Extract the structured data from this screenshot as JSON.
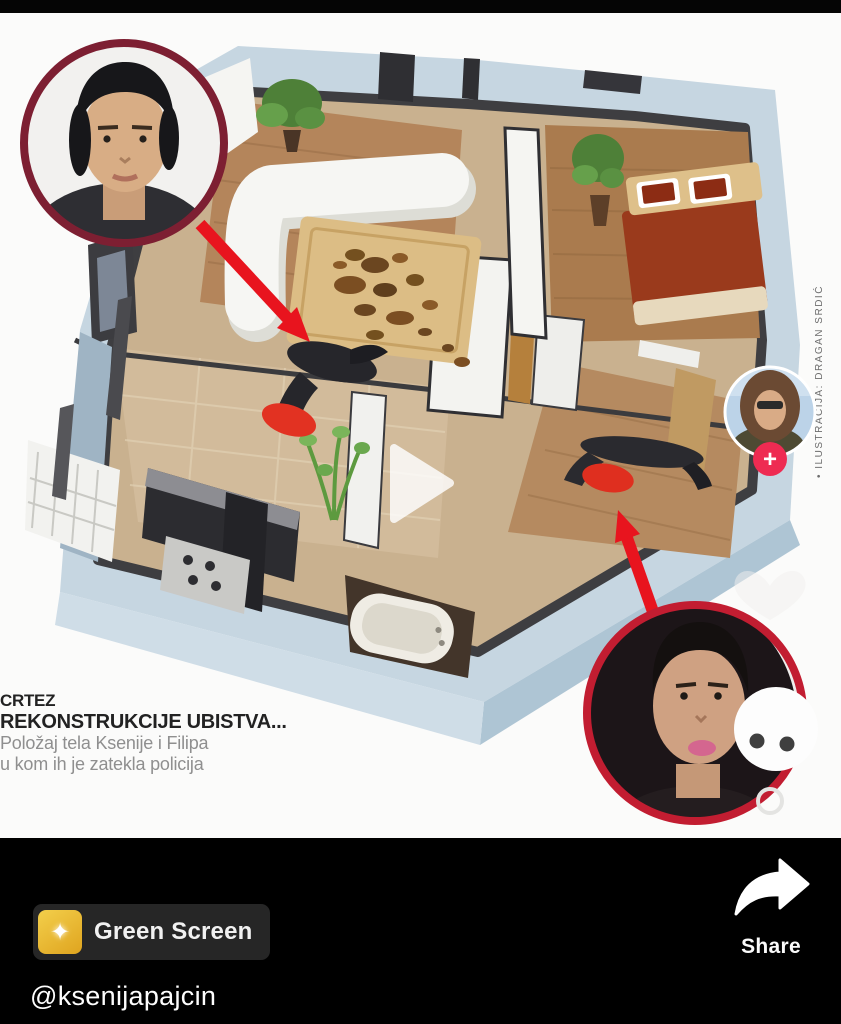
{
  "video": {
    "caption": {
      "line1": "CRTEZ",
      "line2": "REKONSTRUKCIJE UBISTVA...",
      "line3": "Položaj tela Ksenije i Filipa",
      "line4": "u kom ih je zatekla policija"
    },
    "photo_credit": "• ILUSTRACIJA: DRAGAN SRDIĆ",
    "play_icon": "play-triangle"
  },
  "right_rail": {
    "avatar": "profile-photo",
    "follow_glyph": "+",
    "comment_icon": "speech-bubble-dots"
  },
  "bottom_bar": {
    "effect_chip": {
      "icon": "sparkle",
      "glyph": "✦",
      "label": "Green Screen"
    },
    "share": {
      "icon": "share-arrow",
      "label": "Share"
    },
    "username": "@ksenijapajcin"
  },
  "colors": {
    "arrow_red": "#e8141e",
    "male_circle_border": "#7d1f32",
    "female_circle_border": "#c21d31",
    "follow_button_red": "#ee2b52",
    "chip_bg": "#262626",
    "chip_icon_yellow": "#e9b92e",
    "wall_top_gray": "#3e3e41",
    "outer_wall_blue": "#c3d4df"
  }
}
